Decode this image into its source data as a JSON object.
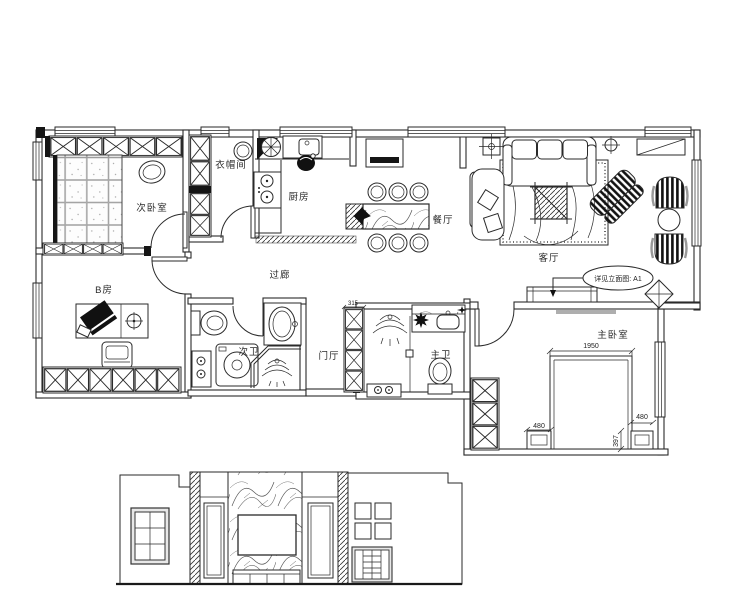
{
  "drawing": {
    "background": "#ffffff",
    "line_color": "#2a2a2a",
    "rooms": {
      "secondary_bedroom": {
        "label": "次卧室"
      },
      "cloakroom": {
        "label": "衣帽间"
      },
      "kitchen": {
        "label": "厨房"
      },
      "dining_room": {
        "label": "餐厅"
      },
      "living_room": {
        "label": "客厅"
      },
      "room_b": {
        "label": "B房"
      },
      "corridor": {
        "label": "过廊"
      },
      "secondary_bathroom": {
        "label": "次卫"
      },
      "foyer": {
        "label": "门厅"
      },
      "master_bathroom": {
        "label": "主卫"
      },
      "master_bedroom": {
        "label": "主卧室"
      }
    },
    "dimensions": {
      "bed_width": "1950",
      "left_nightstand": "480",
      "right_nightstand": "480",
      "nightstand_depth": "397",
      "cabinet_width": "315"
    },
    "callout": {
      "elevation_ref": "详见立面图: A1"
    }
  }
}
